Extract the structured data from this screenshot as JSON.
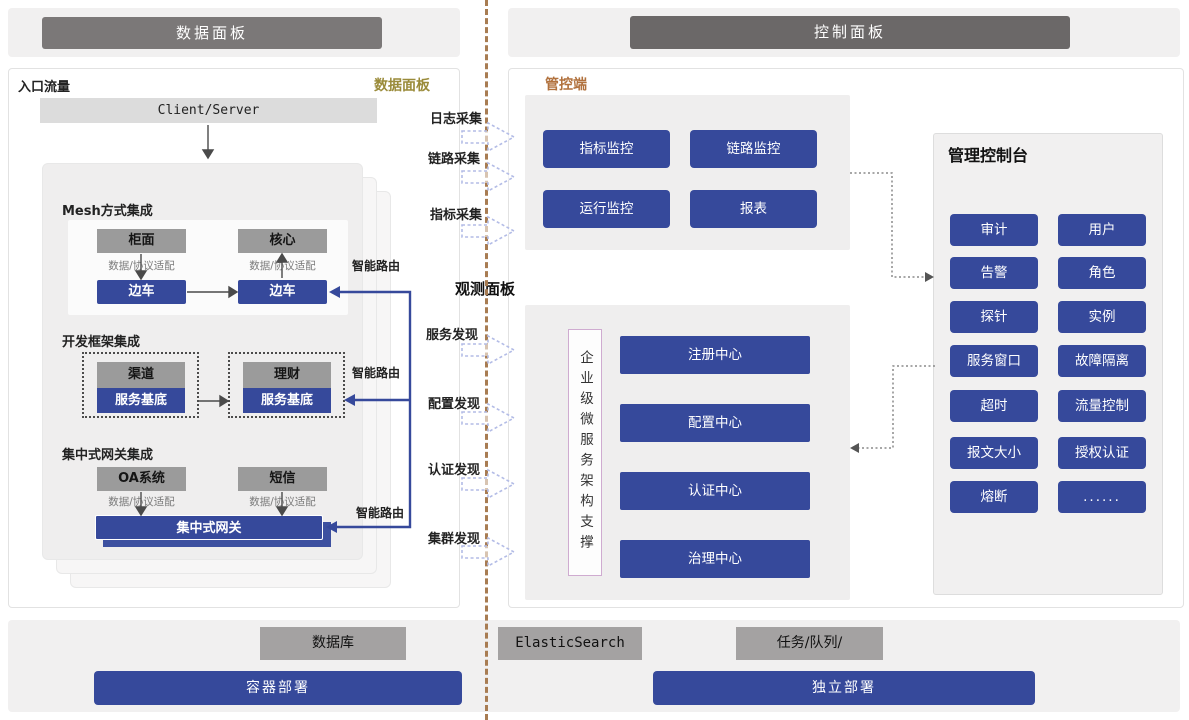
{
  "header": {
    "left_title": "数据面板",
    "right_title": "控制面板"
  },
  "data_panel": {
    "corner_label": "入口流量",
    "panel_label": "数据面板",
    "client_server": "Client/Server",
    "smart_route_label": "智能路由",
    "sections": {
      "mesh": {
        "title": "Mesh方式集成",
        "left_top": "柜面",
        "right_top": "核心",
        "adapter": "数据/协议适配",
        "left_bottom": "边车",
        "right_bottom": "边车"
      },
      "framework": {
        "title": "开发框架集成",
        "left_top": "渠道",
        "right_top": "理财",
        "left_bottom": "服务基底",
        "right_bottom": "服务基底"
      },
      "gateway": {
        "title": "集中式网关集成",
        "left_top": "OA系统",
        "right_top": "短信",
        "adapter": "数据/协议适配",
        "gateway_bar": "集中式网关"
      }
    }
  },
  "flows": {
    "collect": [
      "日志采集",
      "链路采集",
      "指标采集"
    ],
    "observe_title": "观测面板",
    "discover": [
      "服务发现",
      "配置发现",
      "认证发现",
      "集群发现"
    ]
  },
  "control_panel": {
    "manage_label": "管控端",
    "monitor_buttons": [
      "指标监控",
      "链路监控",
      "运行监控",
      "报表"
    ],
    "support_vertical": "企业级微服务架构支撑",
    "centers": [
      "注册中心",
      "配置中心",
      "认证中心",
      "治理中心"
    ],
    "console": {
      "title": "管理控制台",
      "buttons": [
        "审计",
        "用户",
        "告警",
        "角色",
        "探针",
        "实例",
        "服务窗口",
        "故障隔离",
        "超时",
        "流量控制",
        "报文大小",
        "授权认证",
        "熔断",
        "......"
      ]
    }
  },
  "footer": {
    "gray_boxes": [
      "数据库",
      "ElasticSearch",
      "任务/队列/"
    ],
    "blue_boxes": [
      "容器部署",
      "独立部署"
    ]
  },
  "colors": {
    "accent_blue": "#36499b",
    "divider": "#a87c52",
    "olive": "#9a8b3a",
    "orange": "#b1713d"
  }
}
